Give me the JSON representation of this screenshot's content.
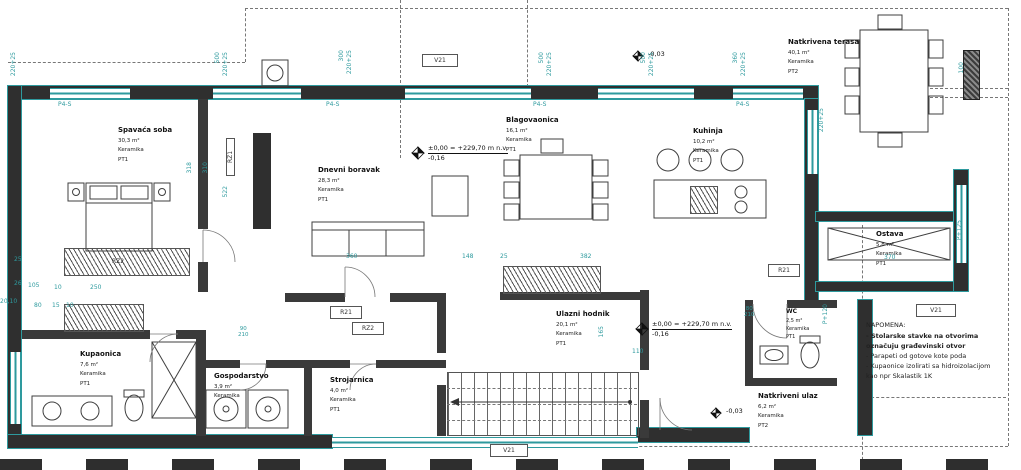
{
  "rooms": {
    "spavaca": {
      "n": "Spavaća soba",
      "a": "30,3 m²",
      "m": "Keramika",
      "f": "PT1"
    },
    "dnevni": {
      "n": "Dnevni boravak",
      "a": "28,3 m²",
      "m": "Keramika",
      "f": "PT1"
    },
    "blagovaonica": {
      "n": "Blagovaonica",
      "a": "16,1 m²",
      "m": "Keramika",
      "f": "PT1"
    },
    "kuhinja": {
      "n": "Kuhinja",
      "a": "10,2 m²",
      "m": "Keramika",
      "f": "PT1"
    },
    "terasa": {
      "n": "Natkrivena terasa",
      "a": "40,1 m²",
      "m": "Keramika",
      "f": "PT2"
    },
    "ostava": {
      "n": "Ostava",
      "a": "5,8 m²",
      "m": "Keramika",
      "f": "PT1"
    },
    "kupaonica": {
      "n": "Kupaonica",
      "a": "7,6 m²",
      "m": "Keramika",
      "f": "PT1"
    },
    "gospodarstvo": {
      "n": "Gospodarstvo",
      "a": "3,9 m²",
      "m": "Keramika",
      "f": "PT1"
    },
    "strojarnica": {
      "n": "Strojarnica",
      "a": "4,0 m²",
      "m": "Keramika",
      "f": "PT1"
    },
    "hodnik": {
      "n": "Ulazni hodnik",
      "a": "20,1 m²",
      "m": "Keramika",
      "f": "PT1"
    },
    "wc": {
      "n": "WC",
      "a": "2,5 m²",
      "m": "Keramika",
      "f": "PT1"
    },
    "ulaz": {
      "n": "Natkriveni ulaz",
      "a": "6,2 m²",
      "m": "Keramika",
      "f": "PT2"
    }
  },
  "levels": {
    "l1": {
      "text": "±0,00 = +229,70 m n.v.",
      "below": "-0,16"
    },
    "l2": {
      "text": "±0,00 = +229,70 m n.v.",
      "below": "-0,16"
    },
    "m1": {
      "text": "-0,03"
    },
    "m2": {
      "text": "-0,03"
    }
  },
  "notes": {
    "title": "NAPOMENA:",
    "items": [
      {
        "text": "- Stolarske stavke na otvorima",
        "bold": true
      },
      {
        "text": "označuju građevinski otvor",
        "bold": true
      },
      {
        "text": "- Parapeti od gotove kote poda",
        "bold": false
      },
      {
        "text": "- Kupaonice izolirati sa hidroizolacijom",
        "bold": false
      },
      {
        "text": "kao npr Skalastik 1K",
        "bold": false
      }
    ]
  },
  "tags": {
    "v21": "V21",
    "p4s": "P4-S",
    "rz1": "RZ1",
    "rz2": "RZ2",
    "r21": "R21",
    "p125": "P+125",
    "p120": "P+120"
  },
  "dims": [
    "500",
    "220+25",
    "300",
    "220+25",
    "500",
    "220+25",
    "500",
    "220+25",
    "360",
    "220+25",
    "220+25",
    "220+25",
    "318",
    "310",
    "522",
    "165",
    "100",
    "360",
    "148",
    "25",
    "382",
    "370",
    "25",
    "26",
    "105",
    "10",
    "80",
    "15",
    "10",
    "20,10",
    "250",
    "110",
    "80",
    "210",
    "90",
    "210"
  ],
  "colors": {
    "accent": "#2e9a9e",
    "wall": "#2f2f2f",
    "dash": "#777777",
    "text": "#1c1c1c"
  }
}
